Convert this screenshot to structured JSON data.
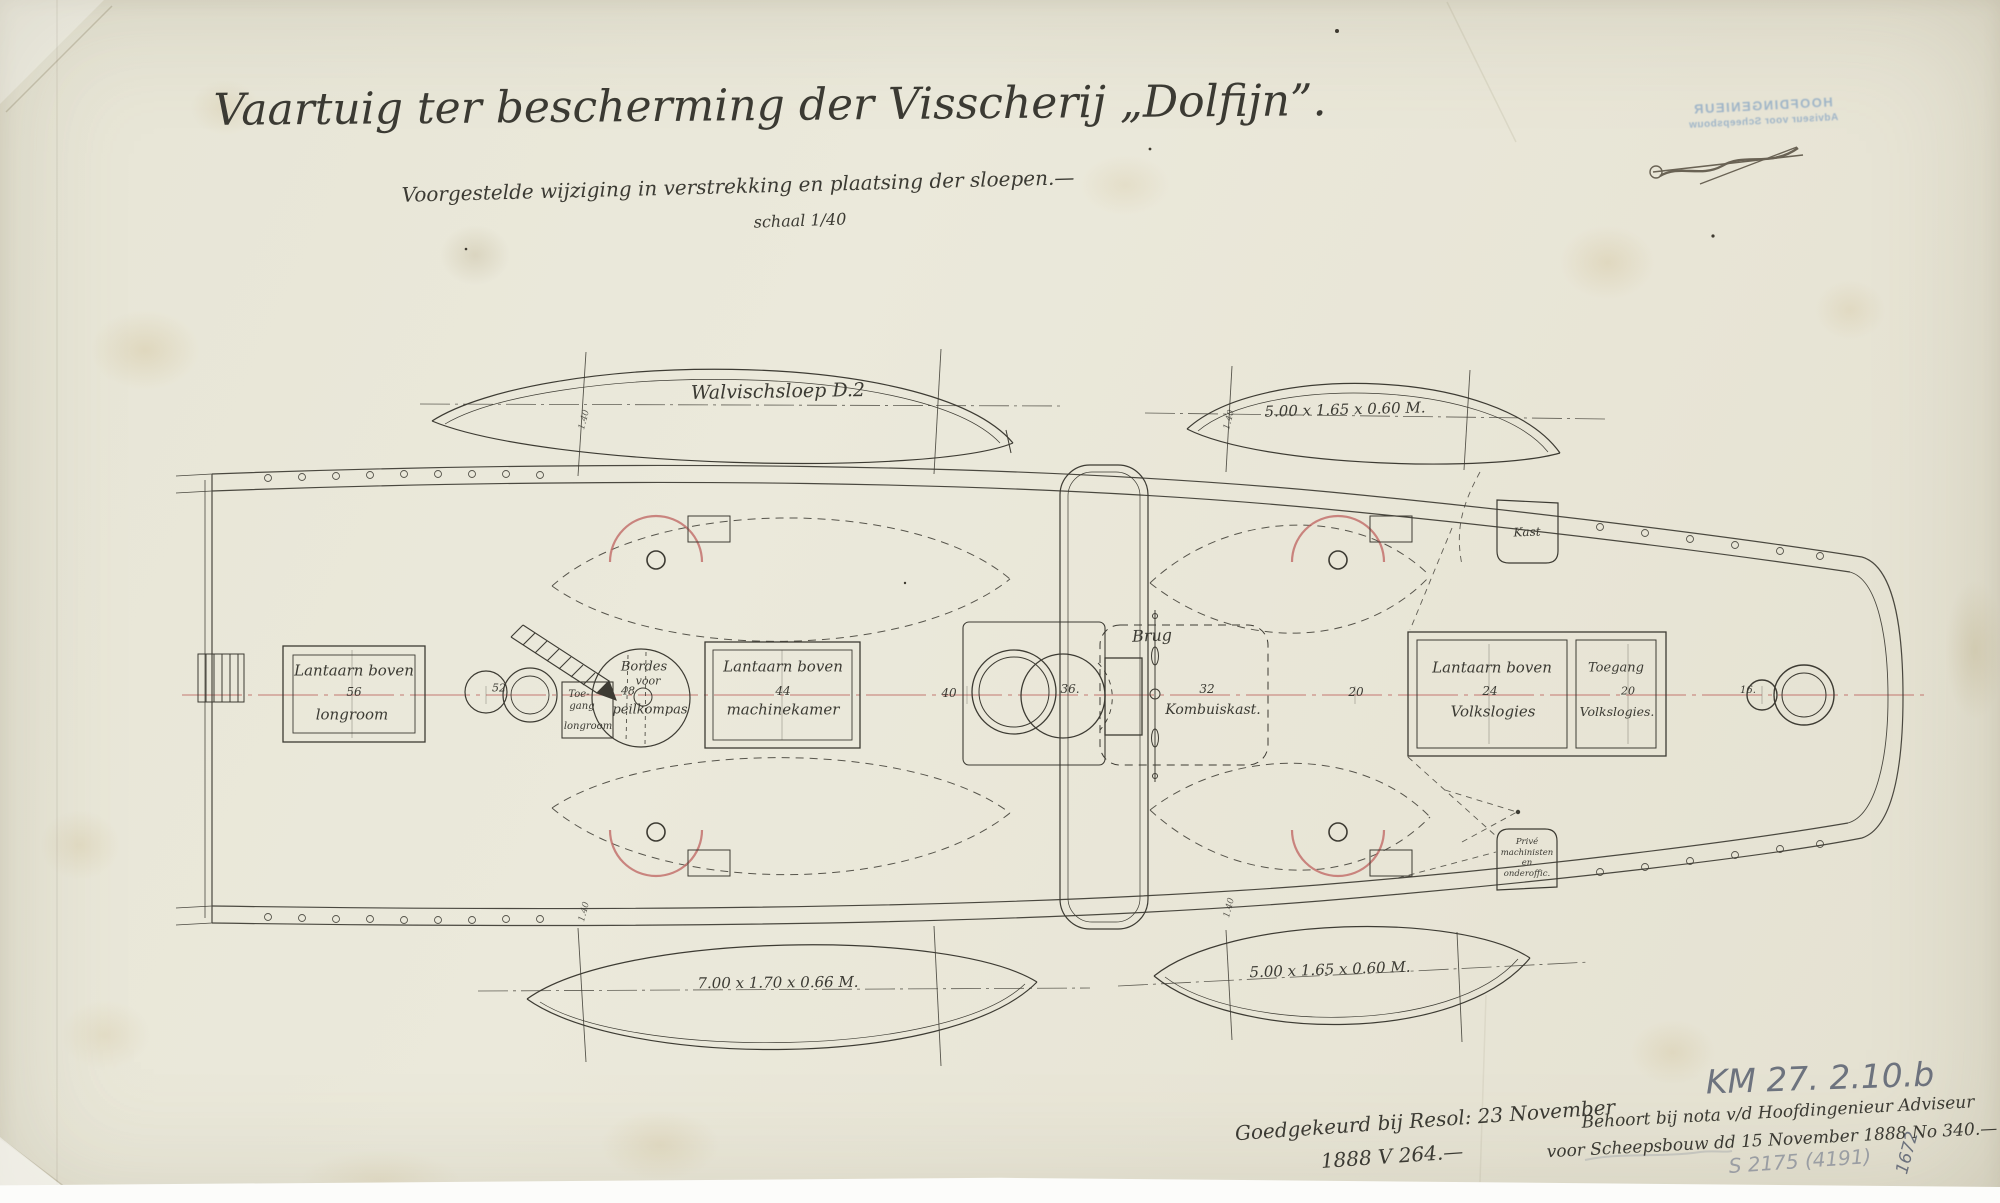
{
  "title": "Vaartuig ter bescherming der Visscherij „Dolfijn”.",
  "subtitle": "Voorgestelde wijziging in verstrekking en plaatsing der sloepen.—",
  "scale_note": "schaal 1/40",
  "stamp": {
    "line1": "HOOFDINGENIEUR",
    "line2": "Adviseur voor Scheepsbouw"
  },
  "boats": {
    "top_left_name": "Walvischsloep D.2",
    "top_right_dim": "5.00 x 1.65 x 0.60 M.",
    "bottom_left_dim": "7.00 x 1.70 x 0.66 M.",
    "bottom_right_dim": "5.00 x 1.65 x 0.60 M.",
    "fall_spacing": "1.40"
  },
  "deck": {
    "longroom": {
      "l1": "Lantaarn boven",
      "num": "56",
      "l2": "longroom"
    },
    "frame52": "52",
    "toegang_longroom": {
      "l1": "Toe-",
      "l2": "gang",
      "l3": "longroom"
    },
    "bordes": {
      "l1": "Bordes",
      "l2": "voor",
      "num": "48",
      "l3": "peilkompas"
    },
    "machinekamer": {
      "l1": "Lantaarn boven",
      "num": "44",
      "l2": "machinekamer"
    },
    "frame40": "40",
    "funnel_num": "36.",
    "brug": "Brug",
    "kombuis": {
      "num": "32",
      "l1": "Kombuiskast."
    },
    "frame20": "20",
    "volkslogies": {
      "l1": "Lantaarn boven",
      "num": "24",
      "l2": "Volkslogies"
    },
    "toegang_volkslogies": {
      "l1": "Toegang",
      "num": "20",
      "l2": "Volkslogies."
    },
    "kast": "Kast",
    "prive": {
      "l1": "Privé",
      "l2": "machinisten",
      "l3": "en",
      "l4": "onderoffic."
    },
    "frame16": "16."
  },
  "notes": {
    "approved1": "Goedgekeurd bij Resol: 23 November",
    "approved2": "1888 V 264.—",
    "km": "KM 27.  2.10.b",
    "behoort1": "Behoort bij nota v/d Hoofdingenieur Adviseur",
    "behoort2": "voor Scheepsbouw dd 15 November 1888 No 340.—",
    "pencil_ref": "S 2175 (4191)",
    "vertical_ref": "1672"
  },
  "colors": {
    "paper": "#e8e6d8",
    "ink": "#3d3b33",
    "red_accent": "#bf6561",
    "stamp_blue": "#7fa0c2",
    "pencil": "#596070"
  }
}
